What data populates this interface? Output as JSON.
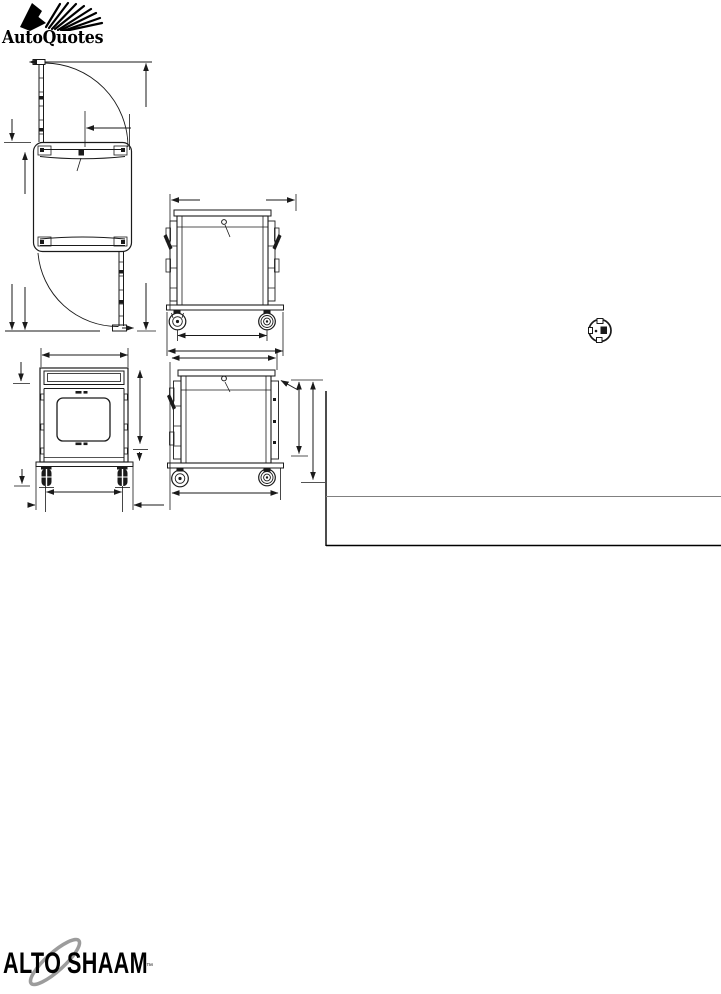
{
  "header": {
    "brand": "AutoQuotes"
  },
  "footer": {
    "brand_alto": "ALTO",
    "brand_shaam": "SHAAM",
    "trademark": "™"
  },
  "colors": {
    "ink": "#1a1a1a",
    "table_rule_gray": "#808080",
    "table_rule_black": "#000000",
    "swoosh_gray": "#9c9c9c"
  }
}
